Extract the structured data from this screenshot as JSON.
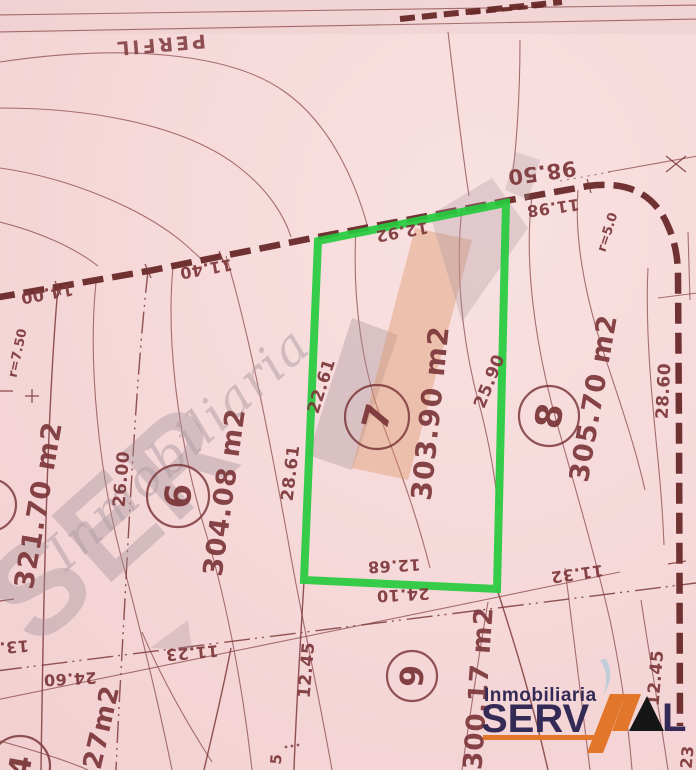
{
  "colors": {
    "paper_pink": "#f6d8d9",
    "ink_red_brown": "#7d383b",
    "parcel_highlight": "#25cb3e",
    "logo_navy": "#342a56",
    "logo_orange": "#e2762b",
    "watermark_gray": "#a5939b",
    "watermark_orange": "#db9364"
  },
  "map": {
    "street_name_top": "PERFIL",
    "highlighted_lot": {
      "number": "7",
      "area": "303.90 m2"
    },
    "labels": [
      {
        "text": "PERFIL",
        "x": 160,
        "y": 45,
        "rot": 175,
        "size": 19,
        "kind": "street-name"
      },
      {
        "text": "98.50",
        "x": 542,
        "y": 173,
        "rot": 172,
        "size": 21,
        "kind": "dim"
      },
      {
        "text": "11.98",
        "x": 553,
        "y": 208,
        "rot": 172,
        "size": 16,
        "kind": "dim"
      },
      {
        "text": "12.92",
        "x": 402,
        "y": 232,
        "rot": 170,
        "size": 16,
        "kind": "dim"
      },
      {
        "text": "11.40",
        "x": 206,
        "y": 269,
        "rot": 170,
        "size": 16,
        "kind": "dim"
      },
      {
        "text": "14.00",
        "x": 47,
        "y": 294,
        "rot": 170,
        "size": 16,
        "kind": "dim"
      },
      {
        "text": "12.68",
        "x": 394,
        "y": 566,
        "rot": 177,
        "size": 16,
        "kind": "dim"
      },
      {
        "text": "24.10",
        "x": 403,
        "y": 595,
        "rot": 177,
        "size": 16,
        "kind": "dim"
      },
      {
        "text": "11.32",
        "x": 577,
        "y": 574,
        "rot": 172,
        "size": 16,
        "kind": "dim"
      },
      {
        "text": "11.23",
        "x": 192,
        "y": 653,
        "rot": 175,
        "size": 16,
        "kind": "dim"
      },
      {
        "text": "24.60",
        "x": 70,
        "y": 679,
        "rot": 177,
        "size": 16,
        "kind": "dim"
      },
      {
        "text": "13.",
        "x": 14,
        "y": 647,
        "rot": 175,
        "size": 16,
        "kind": "dim"
      },
      {
        "text": "22.61",
        "x": 321,
        "y": 386,
        "rot": -72,
        "size": 17,
        "kind": "dim"
      },
      {
        "text": "28.61",
        "x": 290,
        "y": 473,
        "rot": -83,
        "size": 17,
        "kind": "dim"
      },
      {
        "text": "25.90",
        "x": 489,
        "y": 381,
        "rot": -68,
        "size": 17,
        "kind": "dim"
      },
      {
        "text": "28.60",
        "x": 663,
        "y": 391,
        "rot": -87,
        "size": 17,
        "kind": "dim"
      },
      {
        "text": "26.00",
        "x": 121,
        "y": 479,
        "rot": -85,
        "size": 17,
        "kind": "dim"
      },
      {
        "text": "12.45",
        "x": 306,
        "y": 670,
        "rot": -85,
        "size": 17,
        "kind": "dim"
      },
      {
        "text": "12.45",
        "x": 655,
        "y": 678,
        "rot": -85,
        "size": 17,
        "kind": "dim"
      },
      {
        "text": "23",
        "x": 687,
        "y": 757,
        "rot": -85,
        "size": 16,
        "kind": "dim"
      },
      {
        "text": "5",
        "x": 276,
        "y": 759,
        "rot": -85,
        "size": 15,
        "kind": "dim"
      },
      {
        "text": "r=7.50",
        "x": 17,
        "y": 353,
        "rot": -78,
        "size": 13,
        "kind": "radius"
      },
      {
        "text": "r=5.0",
        "x": 607,
        "y": 232,
        "rot": -72,
        "size": 13,
        "kind": "radius"
      },
      {
        "text": "321.70 m2",
        "x": 38,
        "y": 505,
        "rot": -80,
        "size": 27,
        "kind": "area"
      },
      {
        "text": "304.08 m2",
        "x": 224,
        "y": 492,
        "rot": -82,
        "size": 27,
        "kind": "area"
      },
      {
        "text": "303.90 m2",
        "x": 430,
        "y": 413,
        "rot": -84,
        "size": 28,
        "kind": "area"
      },
      {
        "text": "305.70 m2",
        "x": 593,
        "y": 398,
        "rot": -80,
        "size": 27,
        "kind": "area"
      },
      {
        "text": "300.17 m2",
        "x": 478,
        "y": 688,
        "rot": -86,
        "size": 26,
        "kind": "area"
      },
      {
        "text": "27m2",
        "x": 101,
        "y": 727,
        "rot": -77,
        "size": 26,
        "kind": "area"
      }
    ],
    "lots": [
      {
        "number": "6",
        "cx": 178,
        "cy": 496,
        "r": 31,
        "rot": -85,
        "size": 36
      },
      {
        "number": "7",
        "cx": 377,
        "cy": 417,
        "r": 32,
        "rot": -75,
        "size": 36
      },
      {
        "number": "8",
        "cx": 549,
        "cy": 416,
        "r": 30,
        "rot": -80,
        "size": 36
      },
      {
        "number": "9",
        "cx": 412,
        "cy": 676,
        "r": 25,
        "rot": -85,
        "size": 32
      }
    ],
    "partial_lots": [
      {
        "number": "",
        "cx": -10,
        "cy": 505,
        "r": 26,
        "rot": -80,
        "size": 30
      },
      {
        "number": "4",
        "cx": 20,
        "cy": 766,
        "r": 30,
        "rot": -80,
        "size": 30
      }
    ]
  },
  "watermark": {
    "script_text": "Inmobiliaria",
    "block_text": "SER"
  },
  "logo": {
    "line1": "Inmobiliaria",
    "line2": "SERV",
    "suffix": "L"
  }
}
